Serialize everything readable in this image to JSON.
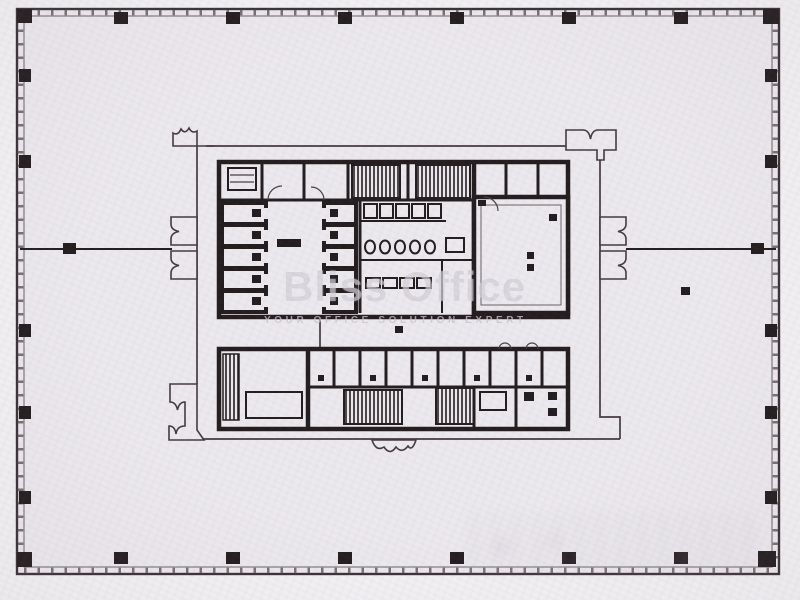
{
  "watermark": {
    "brand": "Bliss Office",
    "tagline": "YOUR OFFICE SOLUTION EXPERT"
  },
  "colors": {
    "paper": "#f3f1f4",
    "floor": "#ece9ee",
    "ink": "#241d1f",
    "watermark_gray": "#cbc8d2"
  }
}
